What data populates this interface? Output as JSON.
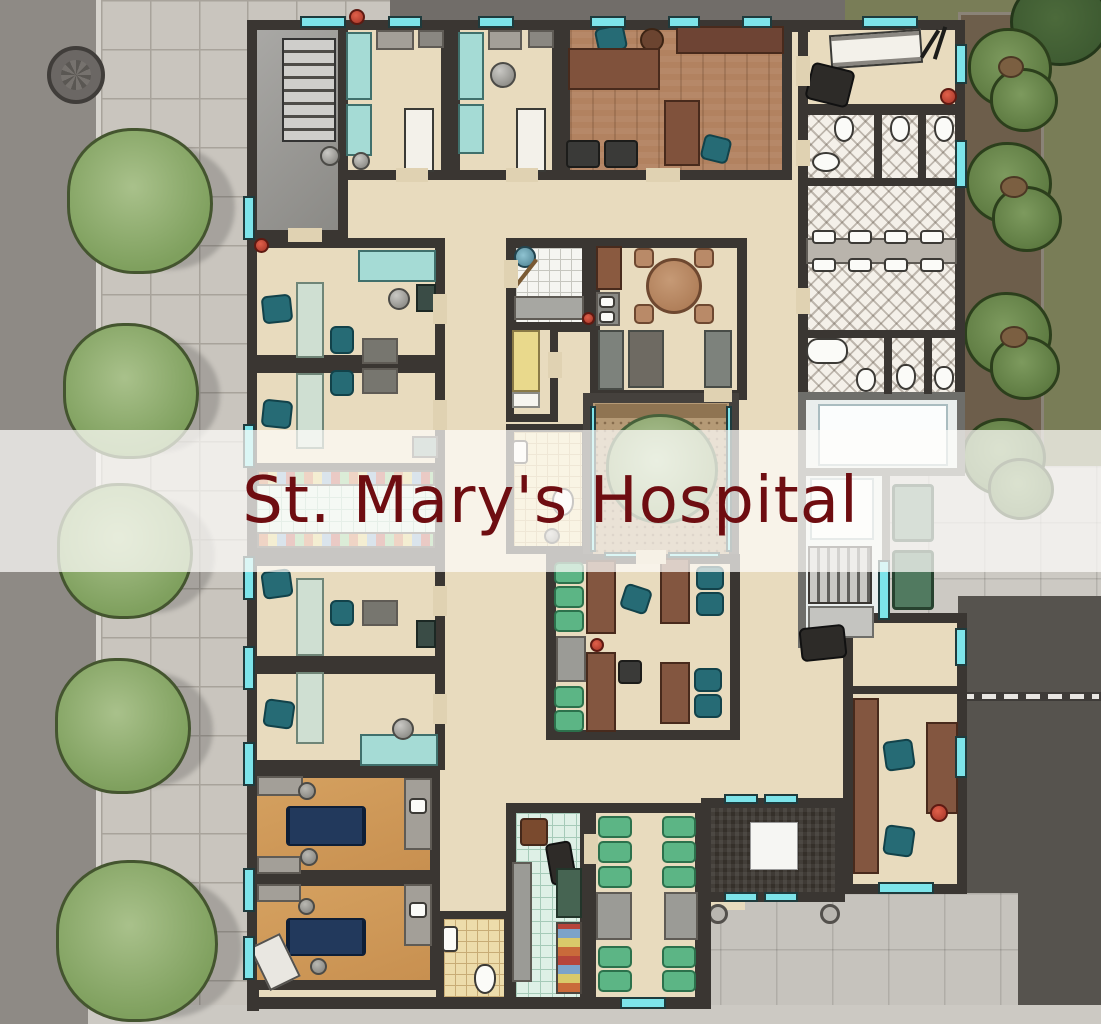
{
  "title": {
    "text": "St. Mary's Hospital"
  },
  "banner": {
    "background": "rgba(253,252,249,0.73)",
    "text_color": "#6e0d11"
  },
  "symbols": {
    "entrance": "red-cross"
  },
  "palette": {
    "wall": "#3a3632",
    "floor_tan": "#e8dbbe",
    "floor_wood": "#b28260",
    "floor_orange": "#d09a58",
    "floor_gray_stairwell": "#9c9b97",
    "tile_green": "#def0e6",
    "tile_white": "#f5f5f1",
    "tile_tan": "#eddcab",
    "restroom_hatch": "#f4f0e9",
    "courtyard_dirt": "#b59a76",
    "window_glass_cyan": "#7de4ea",
    "office_chair_teal": "#266b75",
    "waiting_chair_green": "#5cb585",
    "hospital_bed_teal": "#a5dbd5",
    "procedure_couch_navy": "#22395c",
    "stretcher_green": "#517a60",
    "desk_brown": "#80523c",
    "counter_gray": "#a39f98",
    "road": "#8e8a85",
    "sidewalk": "#c9c5be",
    "plaza_concrete": "#c6c3bd",
    "asphalt": "#56534e",
    "grass": "#797d57",
    "dirt_path": "#6d5e4b",
    "tree_green": "#7fa05e",
    "evergreen": "#5d7a41",
    "marker_red": "#c0392b",
    "cross_red": "#d42a20"
  }
}
